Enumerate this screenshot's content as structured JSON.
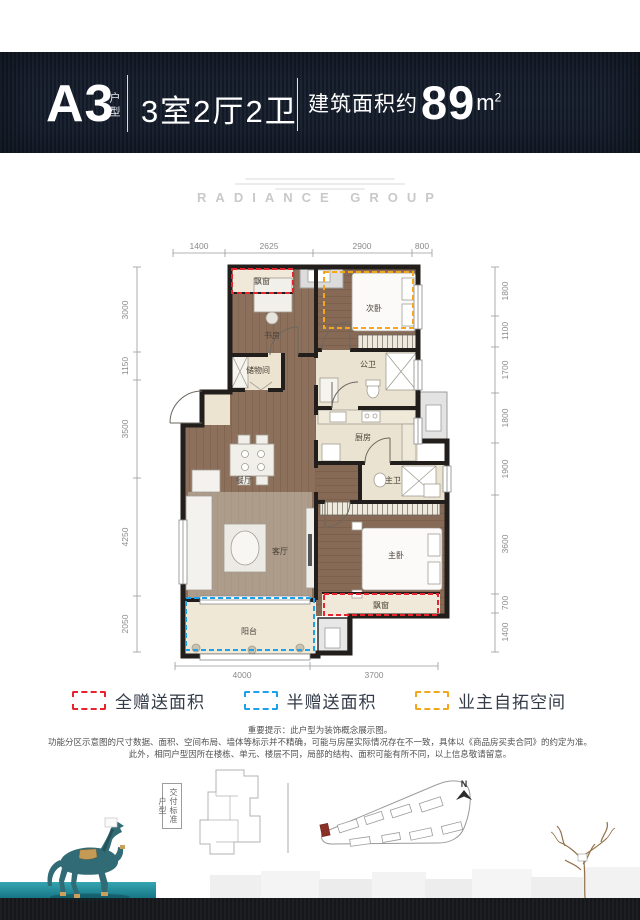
{
  "header": {
    "unit": "A3",
    "unit_suffix": "户型",
    "layout": "3室2厅2卫",
    "area_label": "建筑面积约",
    "area_number": "89",
    "area_unit": "m",
    "area_sup": "2"
  },
  "brand": {
    "name": "RADIANCE GROUP"
  },
  "floorplan": {
    "rooms": {
      "bay_window": "飘窗",
      "study": "书房",
      "second_bedroom": "次卧",
      "storage": "储物间",
      "guest_bathroom": "公卫",
      "kitchen": "厨房",
      "dining_room": "餐厅",
      "master_bathroom": "主卫",
      "living_room": "客厅",
      "master_bedroom": "主卧",
      "balcony": "阳台"
    },
    "dims": {
      "top": [
        "1400",
        "2625",
        "2900",
        "800"
      ],
      "left": [
        "3000",
        "1150",
        "3500",
        "4250",
        "2050"
      ],
      "right": [
        "1800",
        "1100",
        "1700",
        "1800",
        "1900",
        "3600",
        "700",
        "1400"
      ],
      "bottom": [
        "4000",
        "3700"
      ]
    }
  },
  "legend": {
    "items": [
      {
        "label": "全赠送面积",
        "color": "#e8232d"
      },
      {
        "label": "半赠送面积",
        "color": "#1ba2ea"
      },
      {
        "label": "业主自拓空间",
        "color": "#f2a71c"
      }
    ]
  },
  "disclaimer": {
    "line1": "重要提示：此户型为装饰概念展示图。",
    "line2": "功能分区示意图的尺寸数据、面积、空间布局、墙体等标示并不精确，可能与房屋实际情况存在不一致，具体以《商品房买卖合同》的约定为准。",
    "line3": "此外，相同户型因所在楼栋、单元、楼层不同，局部的结构、面积可能有所不同，以上信息敬请留意。"
  },
  "footer": {
    "delivery_label": "交付标准户型",
    "north": "N"
  }
}
